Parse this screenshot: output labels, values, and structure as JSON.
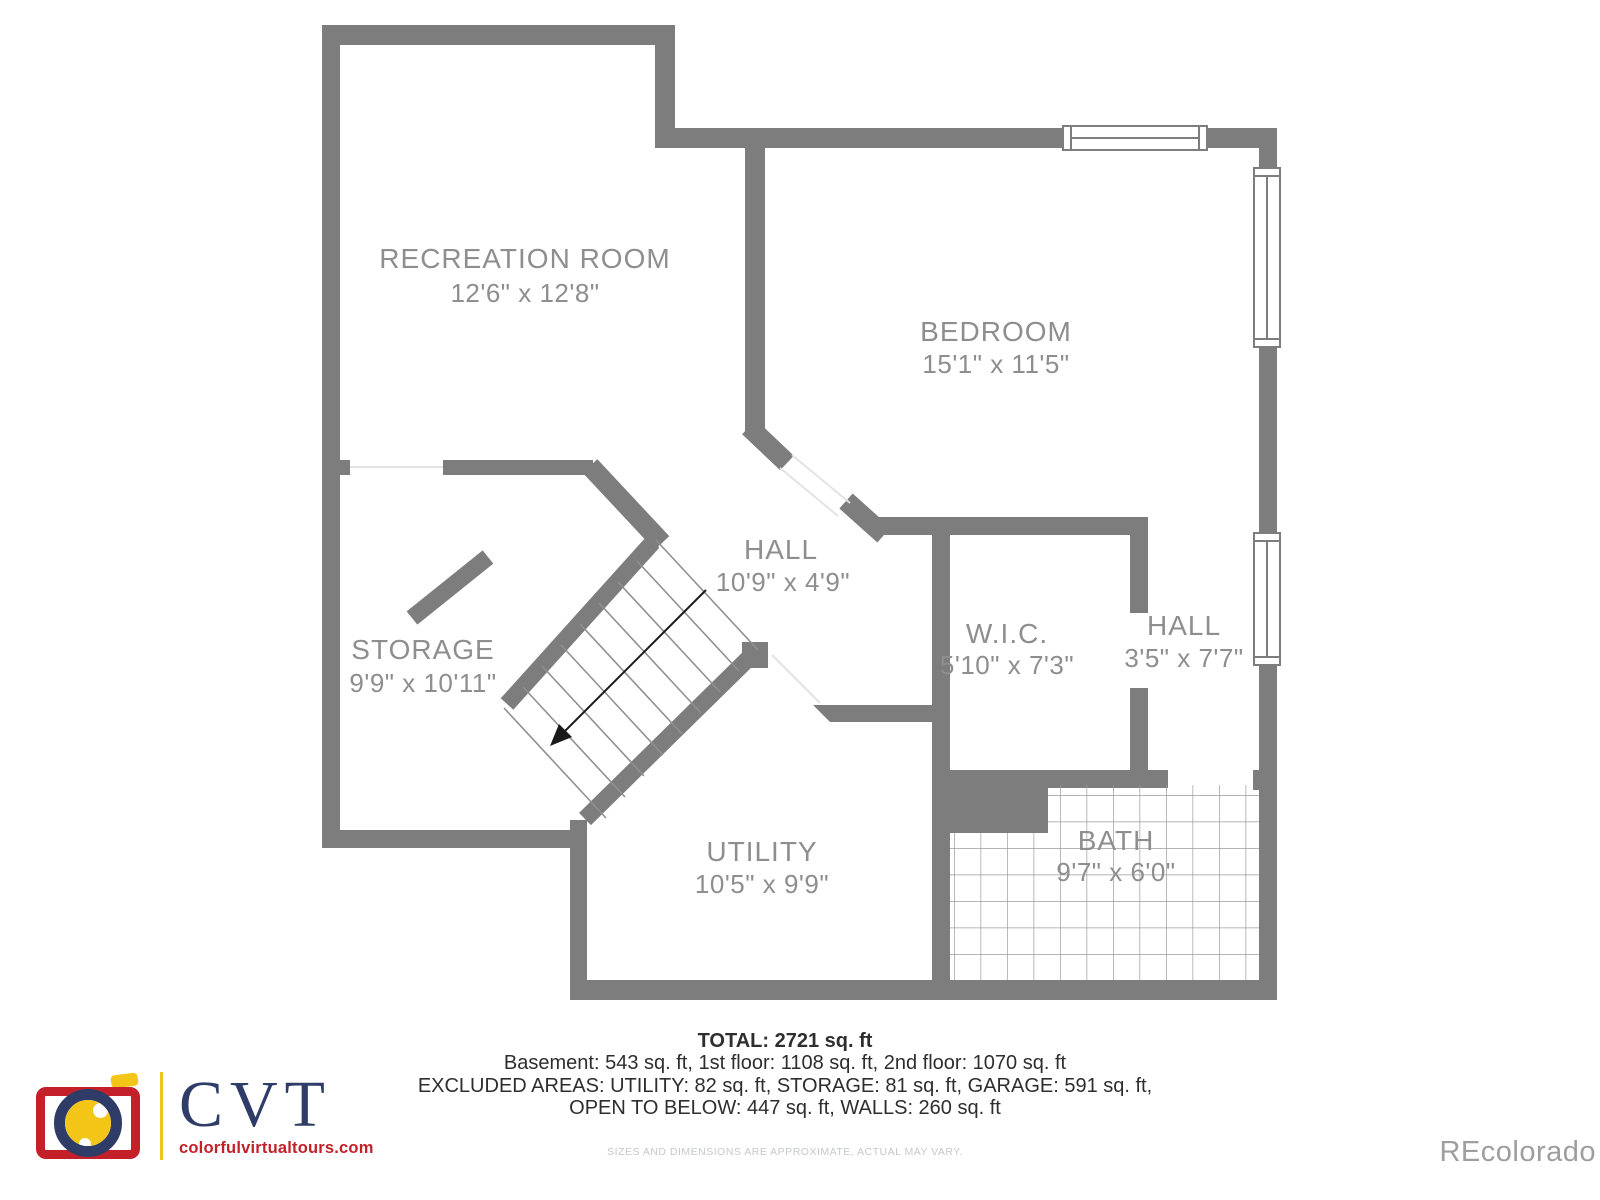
{
  "plan": {
    "level": "basement",
    "rooms": [
      {
        "name": "RECREATION ROOM",
        "dims": "12'6\" x 12'8\""
      },
      {
        "name": "BEDROOM",
        "dims": "15'1\" x 11'5\""
      },
      {
        "name": "HALL",
        "dims": "10'9\" x 4'9\""
      },
      {
        "name": "STORAGE",
        "dims": "9'9\" x 10'11\""
      },
      {
        "name": "W.I.C.",
        "dims": "5'10\" x 7'3\""
      },
      {
        "name": "HALL",
        "dims": "3'5\" x 7'7\""
      },
      {
        "name": "UTILITY",
        "dims": "10'5\" x 9'9\""
      },
      {
        "name": "BATH",
        "dims": "9'7\" x 6'0\""
      }
    ],
    "colors": {
      "wall": "#7d7d7d",
      "tile_line": "#9b9b9b",
      "label": "#8e8e8e"
    }
  },
  "summary": {
    "total": "TOTAL: 2721 sq. ft",
    "line1": "Basement: 543 sq. ft, 1st floor: 1108 sq. ft, 2nd floor: 1070 sq. ft",
    "line2": "EXCLUDED AREAS: UTILITY: 82 sq. ft, STORAGE: 81 sq. ft, GARAGE: 591 sq. ft,",
    "line3": "OPEN TO BELOW: 447 sq. ft, WALLS: 260 sq. ft",
    "disclaimer": "SIZES AND DIMENSIONS ARE APPROXIMATE, ACTUAL MAY VARY."
  },
  "branding": {
    "logo_text": "CVT",
    "logo_url": "colorfulvirtualtours.com",
    "colors": {
      "red": "#c4202a",
      "yellow": "#f3c517",
      "navy": "#2e3c67"
    }
  },
  "watermark": "REcolorado"
}
